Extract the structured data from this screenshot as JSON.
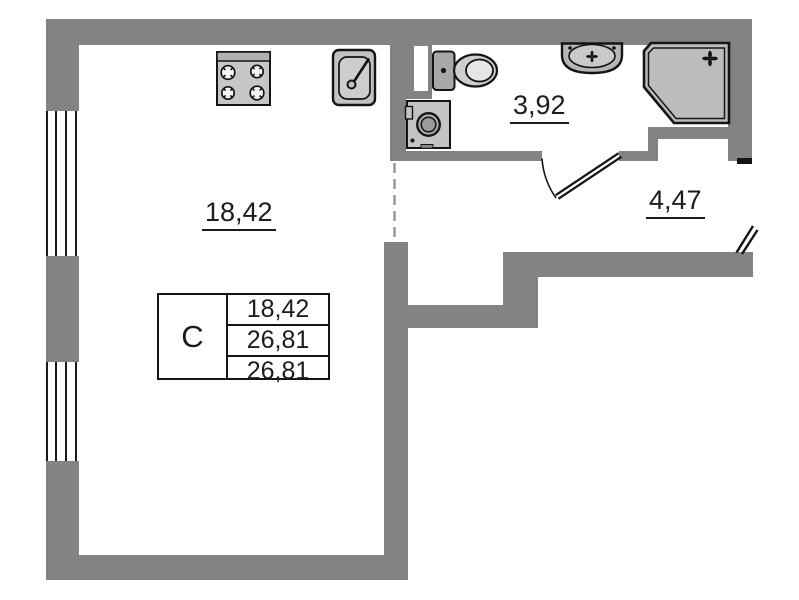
{
  "plan": {
    "rooms": [
      {
        "name": "living-kitchen",
        "area": "18,42"
      },
      {
        "name": "bathroom",
        "area": "3,92"
      },
      {
        "name": "hallway",
        "area": "4,47"
      }
    ],
    "stamp": {
      "type_label": "С",
      "rows": [
        "18,42",
        "26,81",
        "26,81"
      ]
    },
    "fixtures": [
      "stove",
      "kitchen-sink",
      "toilet",
      "washing-machine",
      "washbasin",
      "shower-cabin",
      "window",
      "door-swing",
      "entrance-door"
    ],
    "colors": {
      "wall": "#838383",
      "outline": "#141414",
      "fixture": "#c6c6c6",
      "fixture-dark": "#a8a8a8",
      "shower": "#bcbcbc",
      "dash": "#9a9a9a",
      "bg": "#ffffff"
    }
  }
}
